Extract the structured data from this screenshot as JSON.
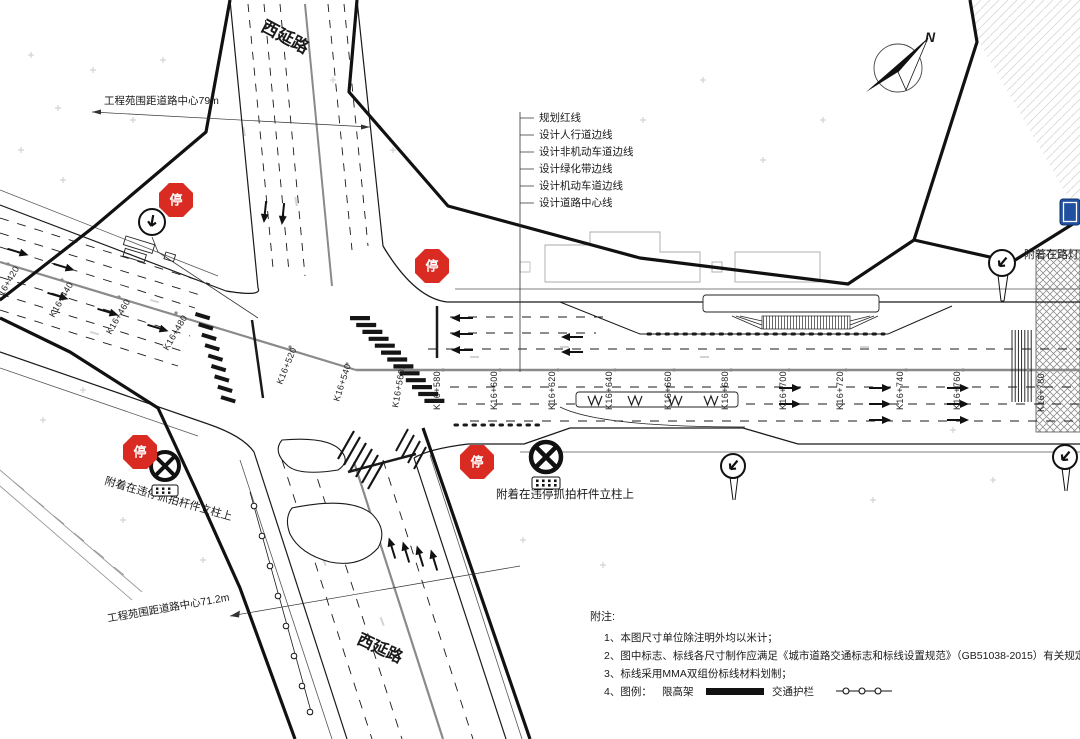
{
  "drawing": {
    "road_name_top": "西延路",
    "road_name_bottom": "西延路",
    "compass_label": "N",
    "annotation_top_left": "工程苑围距道路中心79m",
    "annotation_bottom_left": "工程苑围距道路中心71.2m",
    "annotation_violation_sw": "附着在违停抓拍杆件立柱上",
    "annotation_violation_s": "附着在违停抓拍杆件立柱上",
    "annotation_right_edge": "附着在路灯",
    "stop_stamp": "停",
    "legend_lines": [
      "规划红线",
      "设计人行道边线",
      "设计非机动车道边线",
      "设计绿化带边线",
      "设计机动车道边线",
      "设计道路中心线"
    ],
    "stations": [
      "K16+420",
      "K16+440",
      "K16+460",
      "K16+480",
      "K16+520",
      "K16+540",
      "K16+560",
      "K16+580",
      "K16+600",
      "K16+620",
      "K16+640",
      "K16+660",
      "K16+680",
      "K16+700",
      "K16+720",
      "K16+740",
      "K16+760",
      "K16+780"
    ],
    "notes": {
      "header": "附注:",
      "items": [
        "1、本图尺寸单位除注明外均以米计；",
        "2、图中标志、标线各尺寸制作应满足《城市道路交通标志和标线设置规范》（GB51038-2015）有关规定；",
        "3、标线采用MMA双组份标线材料划制；",
        "4、图例："
      ],
      "legend_item_1": "限高架",
      "legend_item_2": "交通护栏"
    },
    "icons": {
      "stop-sign-stamp": "red octagon with white 停",
      "no-stopping-sign": "black circle with X",
      "direction-sign": "circle with arrow",
      "compass-north": "N needle",
      "guardrail-symbol": "line with circles",
      "height-limit-bar": "solid black bar"
    },
    "colors": {
      "stamp_red": "#d92b21",
      "sign_blue": "#2050a0",
      "line_black": "#1a1a1a",
      "center_gray": "#8a8a8a",
      "faint_gray": "#c9c9c9"
    }
  }
}
